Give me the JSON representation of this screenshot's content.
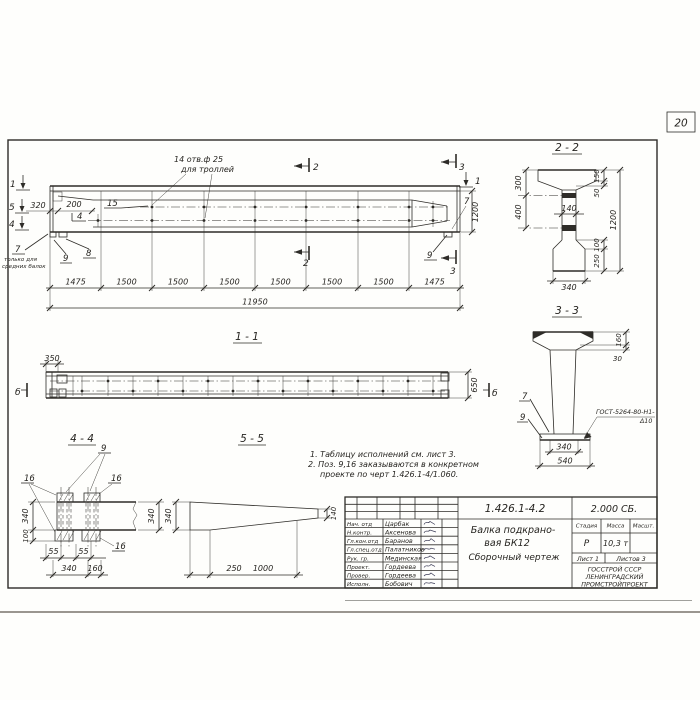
{
  "page": {
    "number": "20"
  },
  "colors": {
    "ink": "#2e2c28",
    "paper": "#fefefc"
  },
  "main_view": {
    "marker_1": "1",
    "marker_5": "5",
    "marker_4": "4",
    "marker_2": "2",
    "marker_3": "3",
    "dim_320": "320",
    "dim_200": "200",
    "pos_15": "15",
    "pos_4": "4",
    "holes_note_1": "14 отв.ф 25",
    "holes_note_2": "для троллей",
    "pos_7": "7",
    "only_note_1": "только для",
    "only_note_2": "средних балок",
    "pos_9": "9",
    "pos_8": "8",
    "pos_7r": "7",
    "pos_9r": "9",
    "dim_1200": "1200",
    "spacings": [
      "1475",
      "1500",
      "1500",
      "1500",
      "1500",
      "1500",
      "1500",
      "1475"
    ],
    "total": "11950"
  },
  "section_2_2": {
    "title": "2 - 2",
    "dim_300": "300",
    "dim_400": "400",
    "dim_150": "150",
    "dim_50": "50",
    "dim_1200": "1200",
    "dim_100": "100",
    "dim_250": "250",
    "dim_140": "140",
    "dim_340": "340"
  },
  "section_3_3": {
    "title": "3 - 3",
    "dim_160": "160",
    "dim_30": "30",
    "pos_7": "7",
    "pos_9": "9",
    "weld_1": "ГОСТ-5264-80-Н1-",
    "weld_2": "Δ10",
    "dim_340": "340",
    "dim_540": "540"
  },
  "view_1_1": {
    "title": "1 - 1",
    "dim_350": "350",
    "dim_650": "650",
    "marker_b": "б"
  },
  "section_4_4": {
    "title": "4 - 4",
    "pos_9": "9",
    "pos_16": "16",
    "dim_340_left": "340",
    "dim_100": "100",
    "dim_55a": "55",
    "dim_55b": "55",
    "dim_340_bot": "340",
    "dim_160": "160",
    "dim_340_right": "340"
  },
  "section_5_5": {
    "title": "5 - 5",
    "dim_340": "340",
    "dim_250": "250",
    "dim_1000": "1000",
    "dim_140": "140"
  },
  "notes": {
    "line1": "1. Таблицу исполнений см. лист 3.",
    "line2": "2. Поз. 9,16 заказываются в конкретном",
    "line3": "проекте по черт 1.426.1-4/1.060."
  },
  "title_block": {
    "doc_number": "1.426.1-4.2",
    "doc_code": "2.000 СБ.",
    "product_1": "Балка подкрано-",
    "product_2": "вая  БК12",
    "product_3": "Сборочный  чертеж",
    "col_stage": "Стадия",
    "col_mass": "Масса",
    "col_scale": "Масшт.",
    "stage": "Р",
    "mass": "10,3 т",
    "sheet": "Лист 1",
    "sheets": "Листов 3",
    "org_1": "ГОССТРОЙ СССР",
    "org_2": "ЛЕНИНГРАДСКИЙ",
    "org_3": "ПРОМСТРОЙПРОЕКТ",
    "staff": [
      {
        "role": "Нач. отд",
        "name": "Царбак"
      },
      {
        "role": "Н.контр.",
        "name": "Аксенова"
      },
      {
        "role": "Гл.кон.отд",
        "name": "Баранов"
      },
      {
        "role": "Гл.спец.отд",
        "name": "Палатников"
      },
      {
        "role": "Рук. гр.",
        "name": "Мединская"
      },
      {
        "role": "Проект.",
        "name": "Гордеева"
      },
      {
        "role": "Провер.",
        "name": "Гордеева"
      },
      {
        "role": "Исполн.",
        "name": "Бобович"
      }
    ]
  }
}
